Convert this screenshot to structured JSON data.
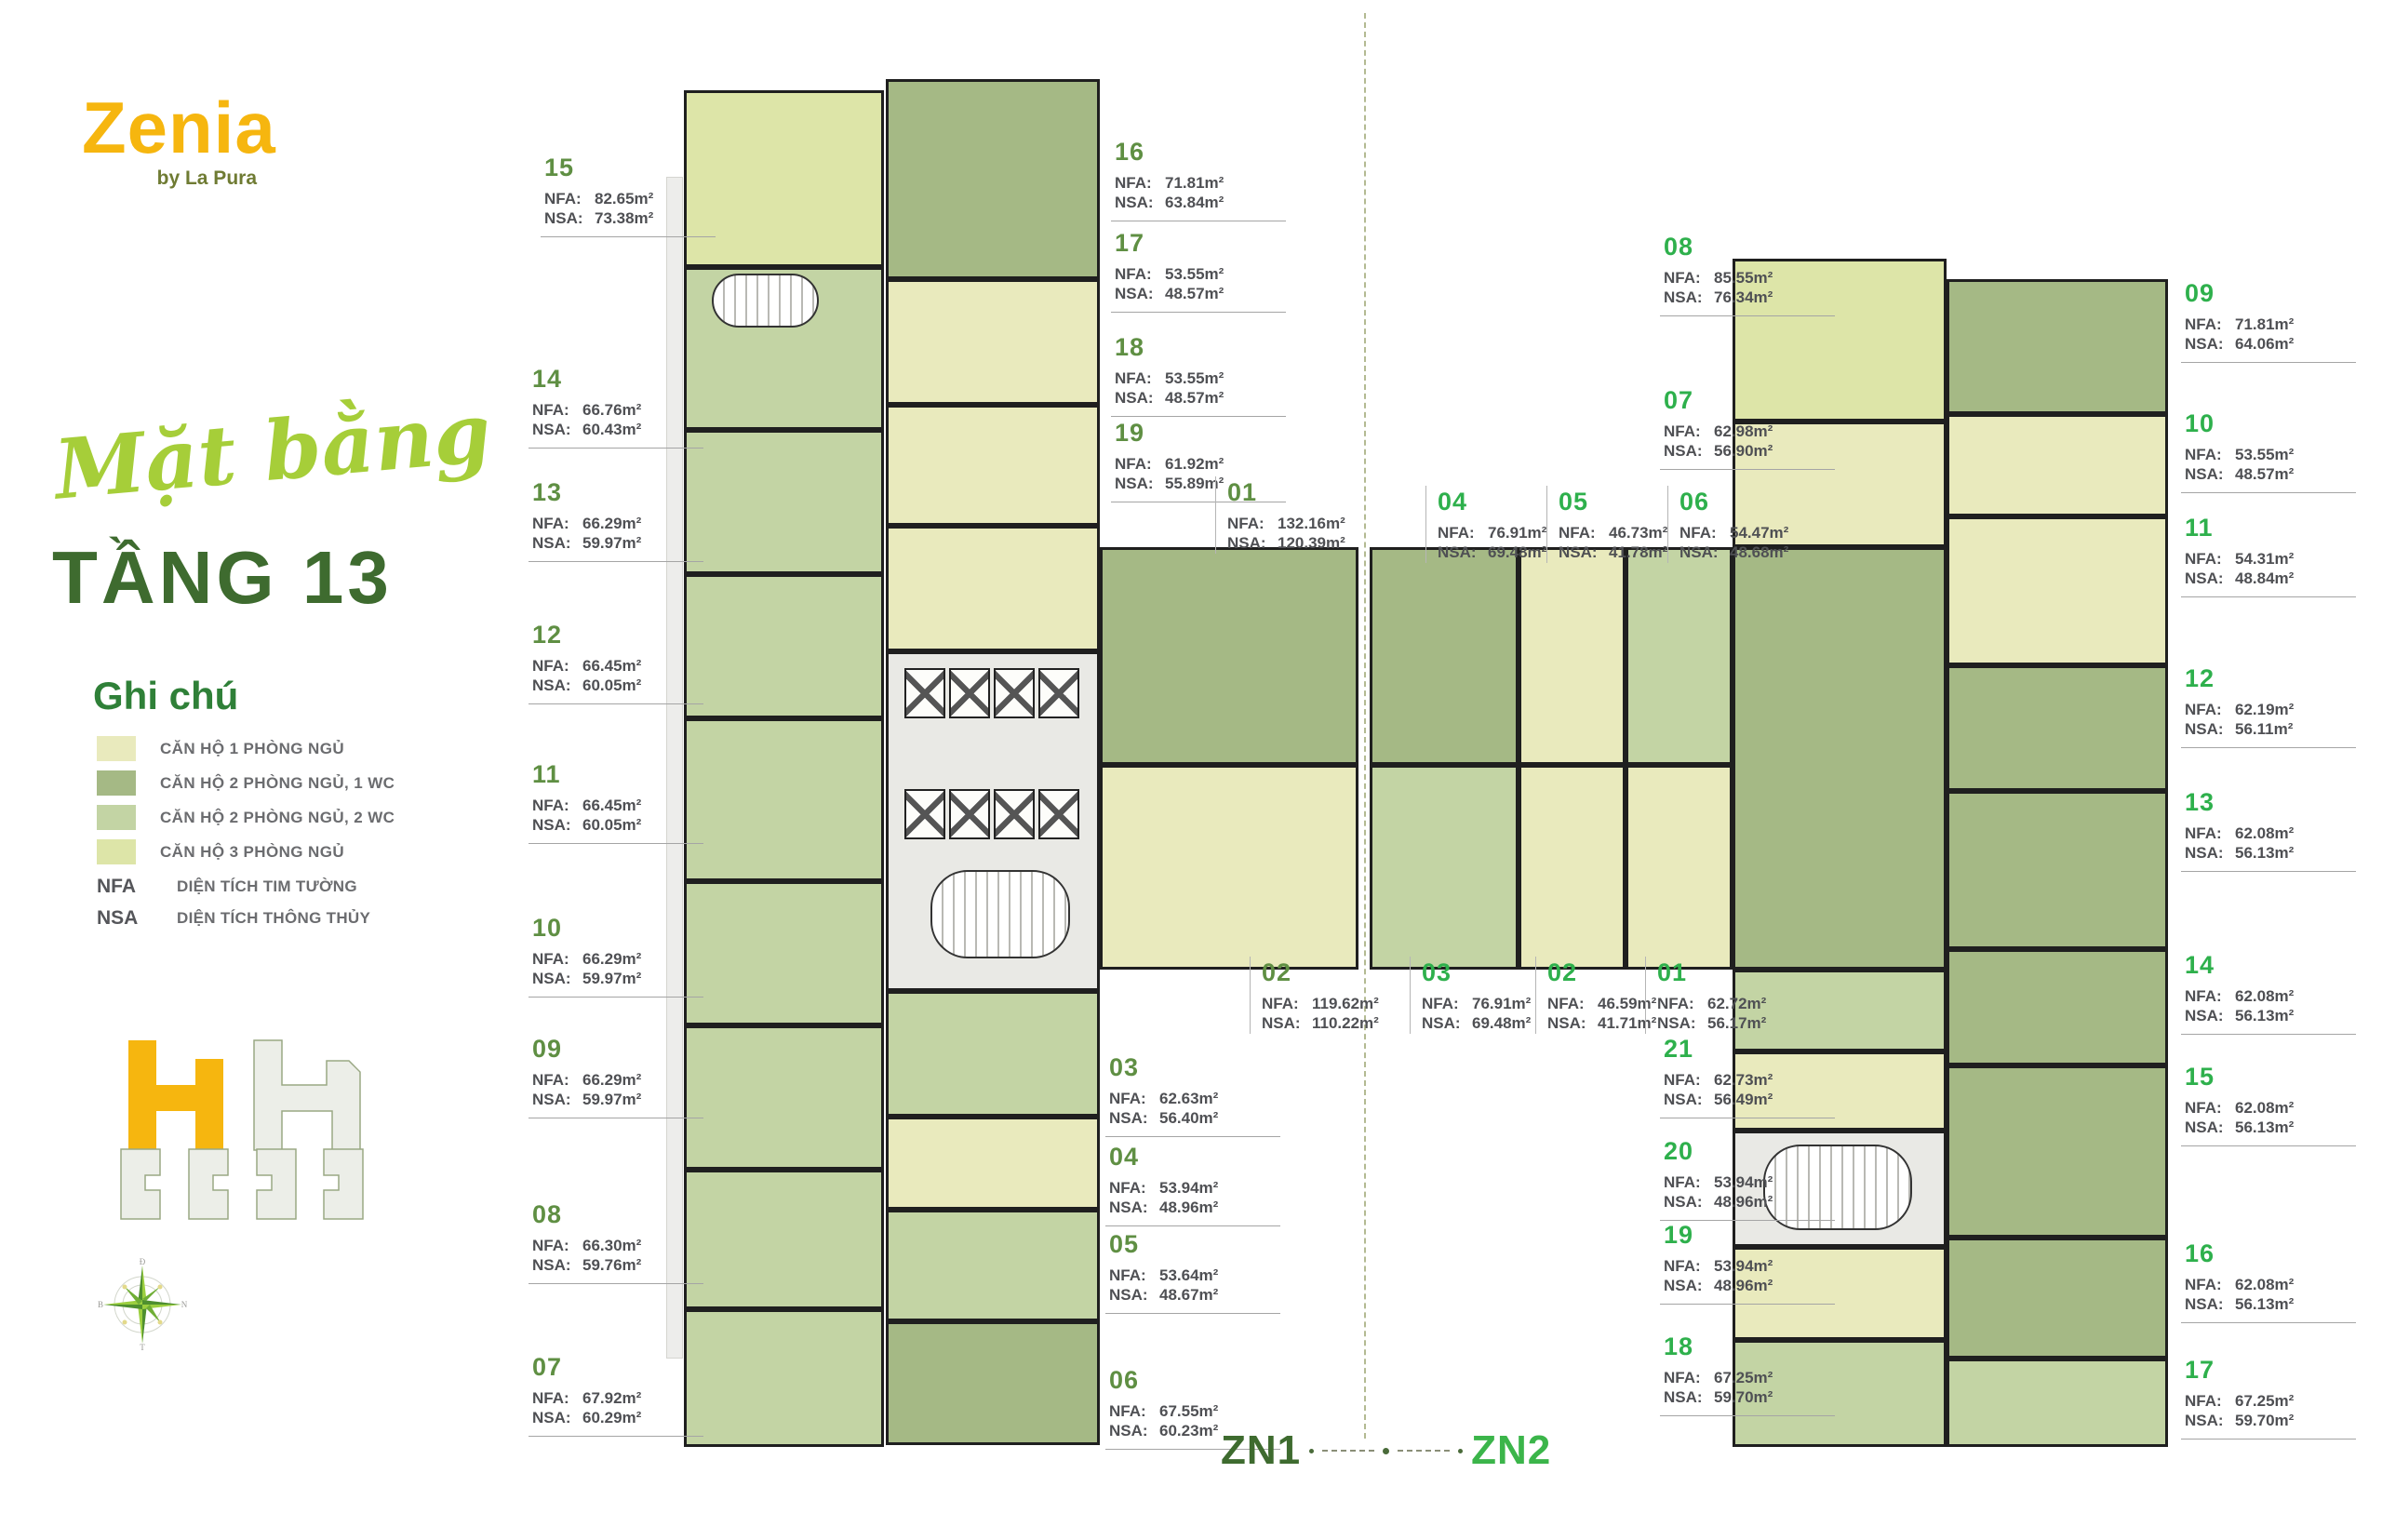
{
  "logo": {
    "name": "Zenia",
    "by": "by La Pura"
  },
  "title": {
    "script": "Mặt bằng",
    "floor": "TẦNG 13"
  },
  "legend": {
    "title": "Ghi chú",
    "items": [
      {
        "color": "#e9eabd",
        "label": "CĂN HỘ 1 PHÒNG NGỦ"
      },
      {
        "color": "#a5b985",
        "label": "CĂN HỘ 2 PHÒNG NGỦ, 1 WC"
      },
      {
        "color": "#c3d4a4",
        "label": "CĂN HỘ 2 PHÒNG NGỦ, 2 WC"
      },
      {
        "color": "#dde5a8",
        "label": "CĂN HỘ 3 PHÒNG NGỦ"
      }
    ],
    "notes": [
      {
        "key": "NFA",
        "label": "DIỆN TÍCH TIM TƯỜNG"
      },
      {
        "key": "NSA",
        "label": "DIỆN TÍCH THÔNG THỦY"
      }
    ]
  },
  "field_labels": {
    "nfa": "NFA:",
    "nsa": "NSA:"
  },
  "zones": {
    "zn1": {
      "name": "ZN1",
      "units": [
        {
          "no": "15",
          "nfa": "82.65m²",
          "nsa": "73.38m²"
        },
        {
          "no": "14",
          "nfa": "66.76m²",
          "nsa": "60.43m²"
        },
        {
          "no": "13",
          "nfa": "66.29m²",
          "nsa": "59.97m²"
        },
        {
          "no": "12",
          "nfa": "66.45m²",
          "nsa": "60.05m²"
        },
        {
          "no": "11",
          "nfa": "66.45m²",
          "nsa": "60.05m²"
        },
        {
          "no": "10",
          "nfa": "66.29m²",
          "nsa": "59.97m²"
        },
        {
          "no": "09",
          "nfa": "66.29m²",
          "nsa": "59.97m²"
        },
        {
          "no": "08",
          "nfa": "66.30m²",
          "nsa": "59.76m²"
        },
        {
          "no": "07",
          "nfa": "67.92m²",
          "nsa": "60.29m²"
        },
        {
          "no": "16",
          "nfa": "71.81m²",
          "nsa": "63.84m²"
        },
        {
          "no": "17",
          "nfa": "53.55m²",
          "nsa": "48.57m²"
        },
        {
          "no": "18",
          "nfa": "53.55m²",
          "nsa": "48.57m²"
        },
        {
          "no": "19",
          "nfa": "61.92m²",
          "nsa": "55.89m²"
        },
        {
          "no": "01",
          "nfa": "132.16m²",
          "nsa": "120.39m²"
        },
        {
          "no": "02",
          "nfa": "119.62m²",
          "nsa": "110.22m²"
        },
        {
          "no": "03",
          "nfa": "62.63m²",
          "nsa": "56.40m²"
        },
        {
          "no": "04",
          "nfa": "53.94m²",
          "nsa": "48.96m²"
        },
        {
          "no": "05",
          "nfa": "53.64m²",
          "nsa": "48.67m²"
        },
        {
          "no": "06",
          "nfa": "67.55m²",
          "nsa": "60.23m²"
        }
      ]
    },
    "zn2": {
      "name": "ZN2",
      "units": [
        {
          "no": "08",
          "nfa": "85.55m²",
          "nsa": "76.34m²"
        },
        {
          "no": "07",
          "nfa": "62.98m²",
          "nsa": "56.90m²"
        },
        {
          "no": "04",
          "nfa": "76.91m²",
          "nsa": "69.48m²"
        },
        {
          "no": "05",
          "nfa": "46.73m²",
          "nsa": "41.78m²"
        },
        {
          "no": "06",
          "nfa": "54.47m²",
          "nsa": "48.68m²"
        },
        {
          "no": "03",
          "nfa": "76.91m²",
          "nsa": "69.48m²"
        },
        {
          "no": "02",
          "nfa": "46.59m²",
          "nsa": "41.71m²"
        },
        {
          "no": "01",
          "nfa": "62.72m²",
          "nsa": "56.17m²"
        },
        {
          "no": "21",
          "nfa": "62.73m²",
          "nsa": "56.49m²"
        },
        {
          "no": "20",
          "nfa": "53.94m²",
          "nsa": "48.96m²"
        },
        {
          "no": "19",
          "nfa": "53.94m²",
          "nsa": "48.96m²"
        },
        {
          "no": "18",
          "nfa": "67.25m²",
          "nsa": "59.70m²"
        },
        {
          "no": "09",
          "nfa": "71.81m²",
          "nsa": "64.06m²"
        },
        {
          "no": "10",
          "nfa": "53.55m²",
          "nsa": "48.57m²"
        },
        {
          "no": "11",
          "nfa": "54.31m²",
          "nsa": "48.84m²"
        },
        {
          "no": "12",
          "nfa": "62.19m²",
          "nsa": "56.11m²"
        },
        {
          "no": "13",
          "nfa": "62.08m²",
          "nsa": "56.13m²"
        },
        {
          "no": "14",
          "nfa": "62.08m²",
          "nsa": "56.13m²"
        },
        {
          "no": "15",
          "nfa": "62.08m²",
          "nsa": "56.13m²"
        },
        {
          "no": "16",
          "nfa": "62.08m²",
          "nsa": "56.13m²"
        },
        {
          "no": "17",
          "nfa": "67.25m²",
          "nsa": "59.70m²"
        }
      ]
    }
  },
  "compass": {
    "top": "Đ",
    "right": "N",
    "bottom": "T",
    "left": "B"
  },
  "colors": {
    "brand_yellow": "#f6b60f",
    "brand_olive": "#6f7b33",
    "title_green": "#3e6b2f",
    "script_green": "#a6ce39",
    "zn1_green": "#5f8f43",
    "zn2_green": "#2eb04c",
    "wall": "#1f1f1f",
    "core_gray": "#e9e9e5"
  }
}
